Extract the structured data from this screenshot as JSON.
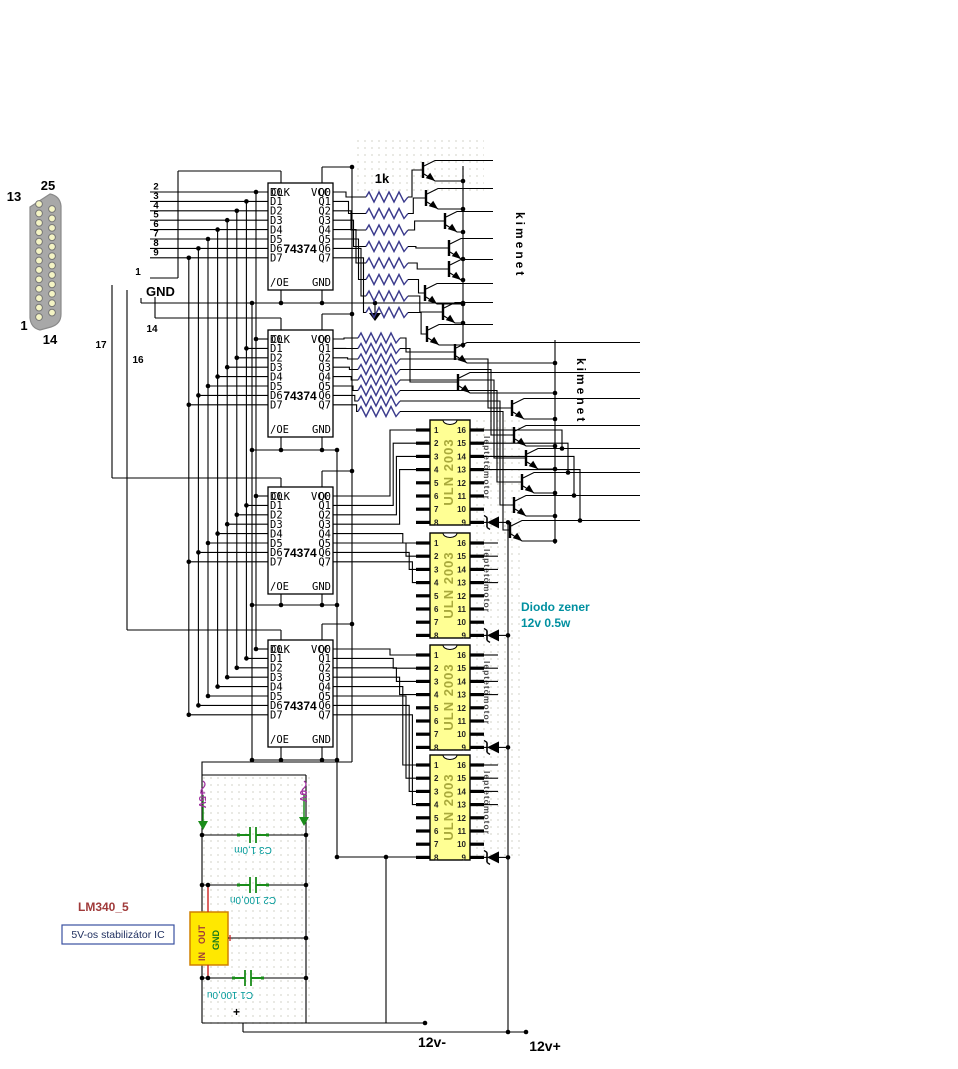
{
  "colors": {
    "wire": "#000000",
    "resistor": "#3A3A8C",
    "uln_fill": "#FFFF94",
    "uln_text": "#A9A93C",
    "motor_label": "#4A4A4A",
    "note_teal": "#0090A0",
    "cap_label": "#009999",
    "cap_green": "#1A8C1A",
    "arrow_green": "#1A8C1A",
    "rail_purple": "#A030A0",
    "part_maroon": "#A03A3A",
    "regulator_fill": "#FFE800",
    "regulator_border": "#D08000",
    "caption_border": "#3A50A0",
    "caption_text": "#203060",
    "red_pin": "#CC2222",
    "connector_body": "#A8A8A8",
    "connector_hole": "#F4F4C4"
  },
  "db25": {
    "corner_labels": [
      "13",
      "25",
      "1",
      "14"
    ]
  },
  "parallel_port_pins": [
    "2",
    "3",
    "4",
    "5",
    "6",
    "7",
    "8",
    "9"
  ],
  "wire_labels": {
    "strobe": "1",
    "gnd": "GND",
    "p14": "14",
    "p17": "17",
    "p16": "16"
  },
  "latch": {
    "name": "74374",
    "pins": {
      "clk": "CLK",
      "vcc": "VCC",
      "oe": "/OE",
      "gnd": "GND"
    },
    "inputs": [
      "D0",
      "D1",
      "D2",
      "D3",
      "D4",
      "D5",
      "D6",
      "D7"
    ],
    "outputs": [
      "Q0",
      "Q1",
      "Q2",
      "Q3",
      "Q4",
      "Q5",
      "Q6",
      "Q7"
    ]
  },
  "resistor_value": "1k",
  "outputs_label": "kimenet",
  "driver": {
    "part": "ULN 2003",
    "left_pin_numbers": [
      "1",
      "2",
      "3",
      "4",
      "5",
      "6",
      "7",
      "8"
    ],
    "right_pin_numbers": [
      "16",
      "15",
      "14",
      "13",
      "12",
      "11",
      "10",
      "9"
    ],
    "side_label": "leptetömotor"
  },
  "zener_note": [
    "Diodo zener",
    "12v 0.5w"
  ],
  "regulator": {
    "part_label": "LM340_5",
    "caption": "5V-os stabilizátor IC",
    "pin_in": "IN",
    "pin_out": "OUT",
    "pin_gnd": "GND"
  },
  "capacitors": [
    "C3 1,0m",
    "C2 100,0n",
    "C1 100,0u"
  ],
  "power_labels": {
    "plus5": "+5V",
    "zero": "0V",
    "plus_mark": "+",
    "neg12": "12v-",
    "pos12": "12v+"
  }
}
